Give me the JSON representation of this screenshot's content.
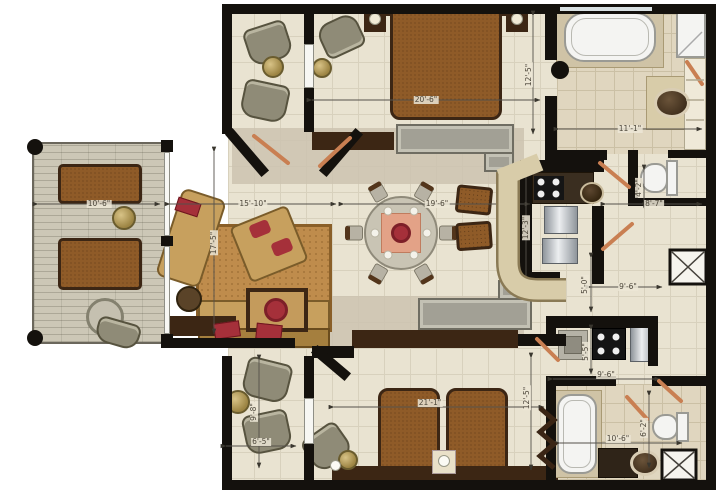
{
  "dims": [
    {
      "t": "20'-6\""
    },
    {
      "t": "12'-5\""
    },
    {
      "t": "11'-1\""
    },
    {
      "t": "10'-6\""
    },
    {
      "t": "15'-10\""
    },
    {
      "t": "19'-6\""
    },
    {
      "t": "8'-7\""
    },
    {
      "t": "17'-5\""
    },
    {
      "t": "12'-3\""
    },
    {
      "t": "5'-0\""
    },
    {
      "t": "9'-6\""
    },
    {
      "t": "5'-5\""
    },
    {
      "t": "9'-6\""
    },
    {
      "t": "21'-1\""
    },
    {
      "t": "12'-5\""
    },
    {
      "t": "10'-6\""
    },
    {
      "t": "6'-2\""
    },
    {
      "t": "6'-5\""
    },
    {
      "t": "9'-8\""
    },
    {
      "t": "4'-2\""
    }
  ],
  "colors": {
    "wall": "#14110d",
    "floor": "#e9e3d1",
    "tile_line": "#d8d1bd",
    "stone": "#e0d6bf",
    "stone_line": "#cbc0a5",
    "taupe": "#cdc3b0",
    "terrace": "#ccc7b6",
    "bed": "#8f5b28",
    "wood_dark": "#3c2614",
    "sofa": "#c7a05e",
    "accent_red": "#a5303a",
    "rug": "#bf8c4c",
    "door": "#c97f52",
    "granite": "#d8cca9",
    "fixture": "#f4f4f2",
    "dim_text": "#4c463a"
  }
}
